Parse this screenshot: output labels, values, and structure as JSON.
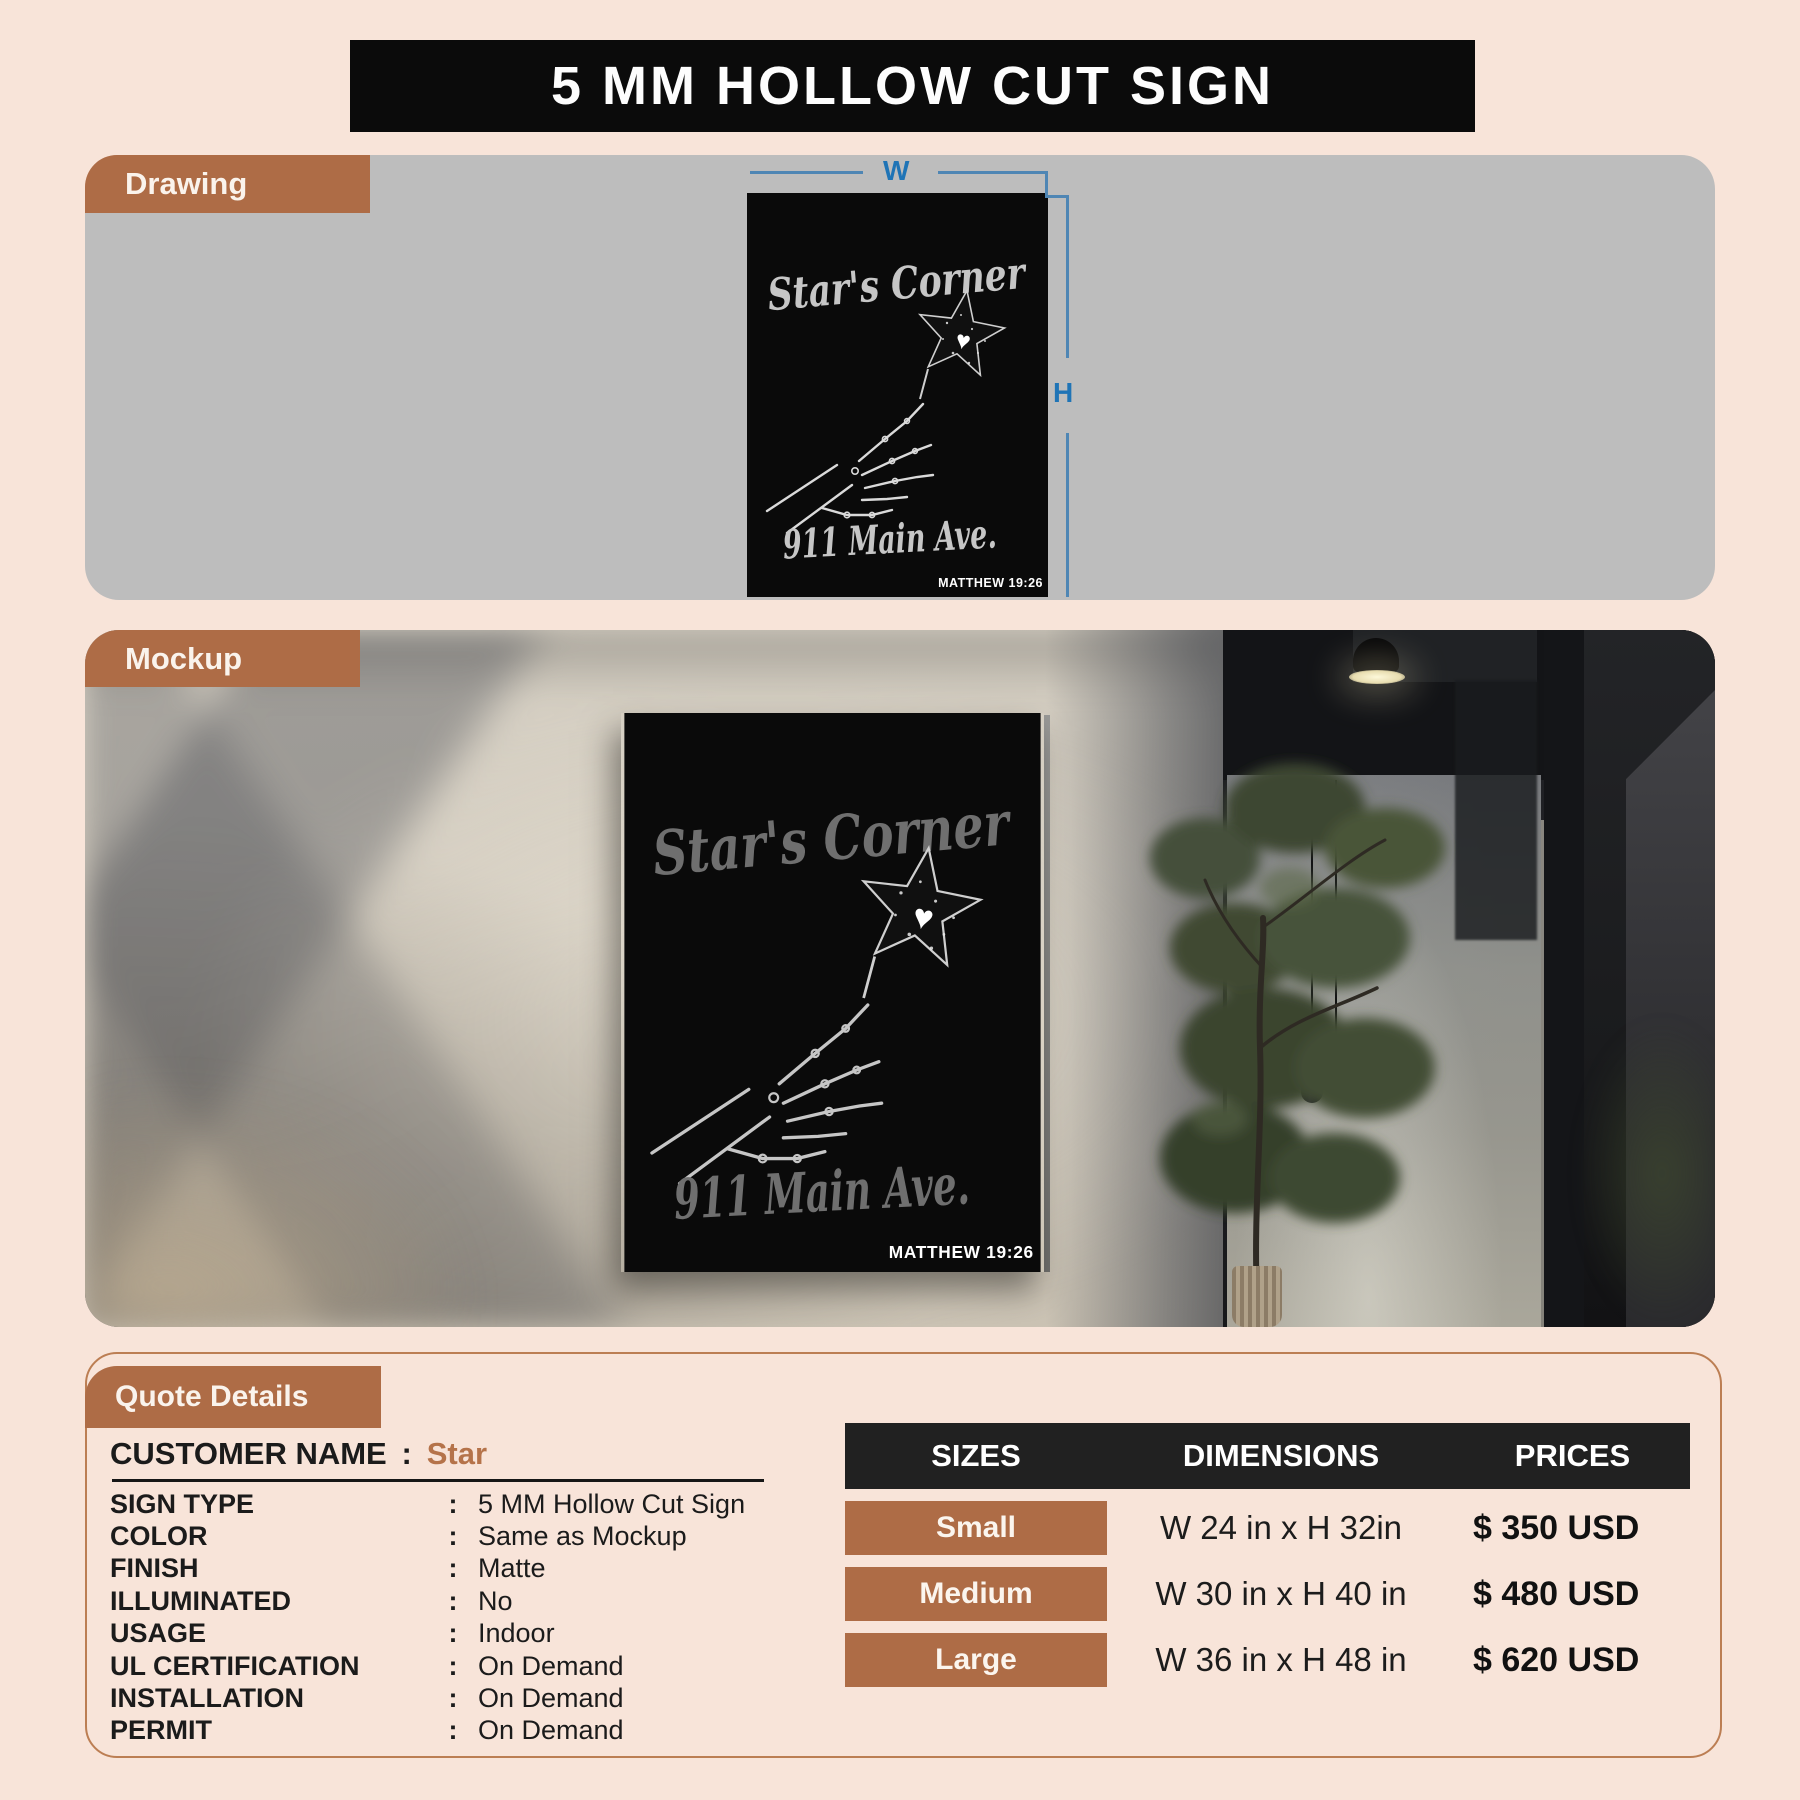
{
  "title": "5 MM HOLLOW CUT SIGN",
  "tabs": {
    "drawing": "Drawing",
    "mockup": "Mockup",
    "quote": "Quote Details"
  },
  "dims": {
    "w": "W",
    "h": "H"
  },
  "sign": {
    "name": "Star's Corner",
    "address": "911 Main Ave.",
    "verse": "MATTHEW 19:26",
    "heart": "♥"
  },
  "quote": {
    "colon": ":",
    "customer": {
      "label": "CUSTOMER NAME",
      "value": "Star"
    },
    "details": [
      {
        "label": "SIGN TYPE",
        "value": "5 MM Hollow Cut Sign"
      },
      {
        "label": "COLOR",
        "value": "Same as Mockup"
      },
      {
        "label": "FINISH",
        "value": "Matte"
      },
      {
        "label": "ILLUMINATED",
        "value": "No"
      },
      {
        "label": "USAGE",
        "value": "Indoor"
      },
      {
        "label": "UL CERTIFICATION",
        "value": "On Demand"
      },
      {
        "label": "INSTALLATION",
        "value": "On Demand"
      },
      {
        "label": "PERMIT",
        "value": "On Demand"
      }
    ]
  },
  "pricing": {
    "headers": [
      "SIZES",
      "DIMENSIONS",
      "PRICES"
    ],
    "rows": [
      {
        "size": "Small",
        "dimensions": "W 24 in x H 32in",
        "price": "$ 350 USD"
      },
      {
        "size": "Medium",
        "dimensions": "W 30 in x H 40 in",
        "price": "$ 480 USD"
      },
      {
        "size": "Large",
        "dimensions": "W 36 in x H 48 in",
        "price": "$ 620 USD"
      }
    ]
  },
  "colors": {
    "page_bg": "#f8e4d9",
    "accent_brown": "#ae6c46",
    "banner_black": "#0b0b0b",
    "table_header_black": "#212121",
    "panel_gray": "#bdbdbd",
    "dimension_blue": "#1f74b6",
    "customer_value_brown": "#b5734a",
    "quote_border": "#bc7e53"
  }
}
